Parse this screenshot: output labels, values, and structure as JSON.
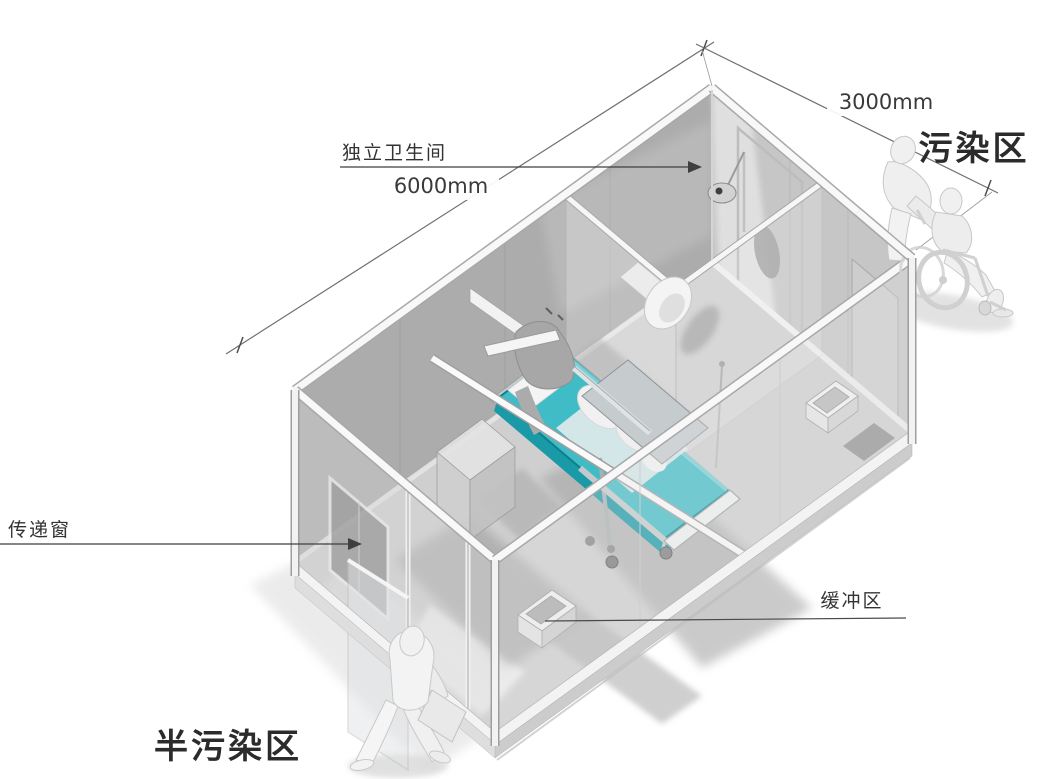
{
  "labels": {
    "bathroom_callout": "独立卫生间",
    "length_dimension": "6000mm",
    "width_dimension": "3000mm",
    "contaminated_zone": "污染区",
    "transfer_window_callout": "传递窗",
    "buffer_zone_callout": "缓冲区",
    "semi_contaminated_zone": "半污染区"
  },
  "colors": {
    "mattress_teal_top": "#3fbcc6",
    "mattress_teal_side": "#1a99a7",
    "mattress_teal_edge": "#0e7f8d",
    "wall_back_gray": "#acacac",
    "wall_end_gray": "#c6c6c6",
    "floor_gray": "#cfcfcf",
    "frame_white": "#f8f8f8",
    "annotation_line": "#4a4a4a",
    "annotation_text": "#3a3a3a",
    "zone_text": "#2b2b2b"
  },
  "scene": {
    "figures": [
      "patient-on-bed",
      "walking-person",
      "caregiver-pushing-wheelchair",
      "wheelchair-patient"
    ],
    "fixtures": [
      "hospital-bed",
      "overbed-table",
      "toilet",
      "shower-head",
      "transfer-window",
      "entry-door",
      "handwash-basin",
      "buffer-sink",
      "bedside-cabinet"
    ]
  }
}
